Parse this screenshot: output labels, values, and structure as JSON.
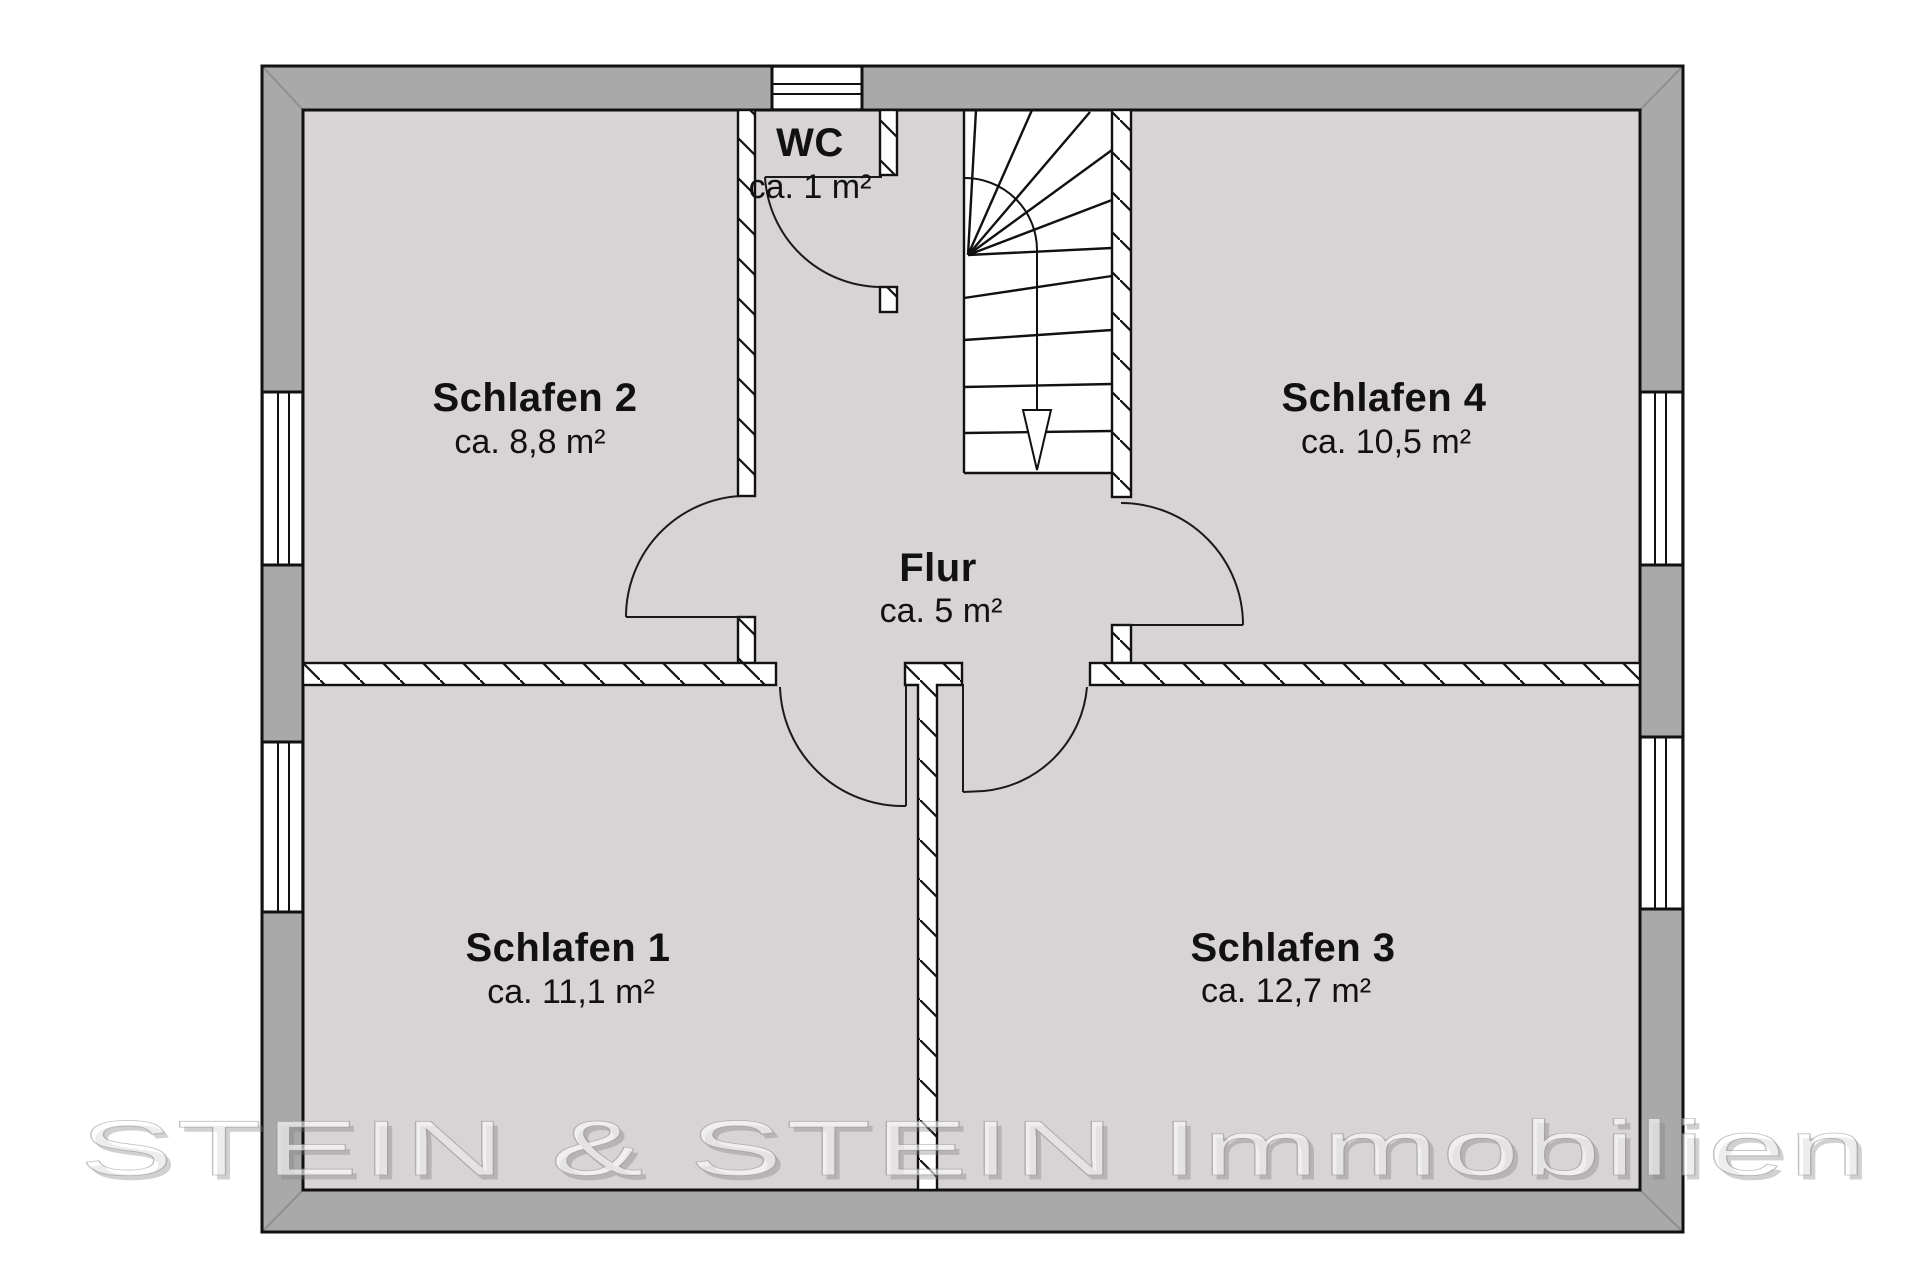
{
  "watermark": "STEIN & STEIN Immobilien",
  "colors": {
    "background": "#ffffff",
    "room_fill": "#d8d3d5",
    "wall_fill": "#a9a9a9",
    "stair_fill": "#ffffff",
    "line": "#111111"
  },
  "rooms": [
    {
      "name": "Schlafen 2",
      "area": "ca. 8,8 m²"
    },
    {
      "name": "WC",
      "area": "ca. 1 m²"
    },
    {
      "name": "Schlafen 4",
      "area": "ca. 10,5 m²"
    },
    {
      "name": "Flur",
      "area": "ca. 5 m²"
    },
    {
      "name": "Schlafen 1",
      "area": "ca. 11,1 m²"
    },
    {
      "name": "Schlafen 3",
      "area": "ca. 12,7 m²"
    }
  ]
}
